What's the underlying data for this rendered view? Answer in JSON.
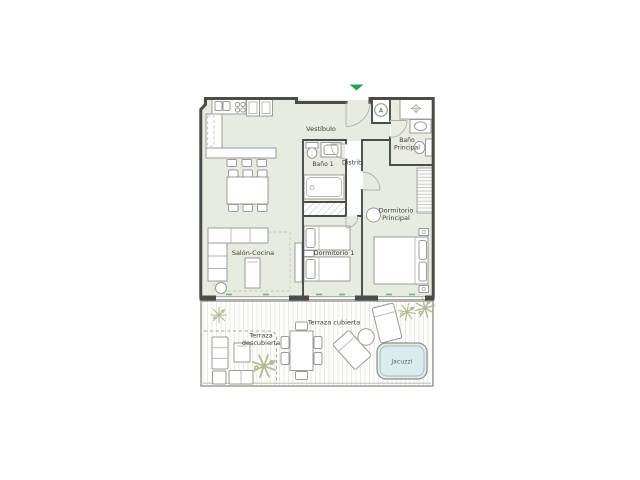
{
  "plan": {
    "colors": {
      "wall": "#4b4b48",
      "room_fill": "#e7ece2",
      "bath_fill": "#eaece3",
      "closet_fill": "#ffffff",
      "jacuzzi_fill": "#daecee",
      "entrance_arrow": "#2f9e4f",
      "window_tick": "#7fb080",
      "marker_ring": "#7dac88"
    },
    "rooms": {
      "vestibulo": {
        "label": "Vestíbulo"
      },
      "bano_1": {
        "label": "Baño 1"
      },
      "distribuidor": {
        "label": "Distrib."
      },
      "bano_principal": {
        "label_line1": "Baño",
        "label_line2": "Principal"
      },
      "dormitorio_principal": {
        "label_line1": "Dormitorio",
        "label_line2": "Principal"
      },
      "salon_cocina": {
        "label": "Salón-Cocina"
      },
      "dormitorio_1": {
        "label": "Dormitorio 1"
      },
      "terraza_cubierta": {
        "label": "Terraza cubierta"
      },
      "terraza_descubierta": {
        "label_line1": "Terraza",
        "label_line2": "descubierta"
      },
      "jacuzzi": {
        "label": "Jacuzzi"
      }
    },
    "markers": {
      "access_marker": "A"
    }
  }
}
